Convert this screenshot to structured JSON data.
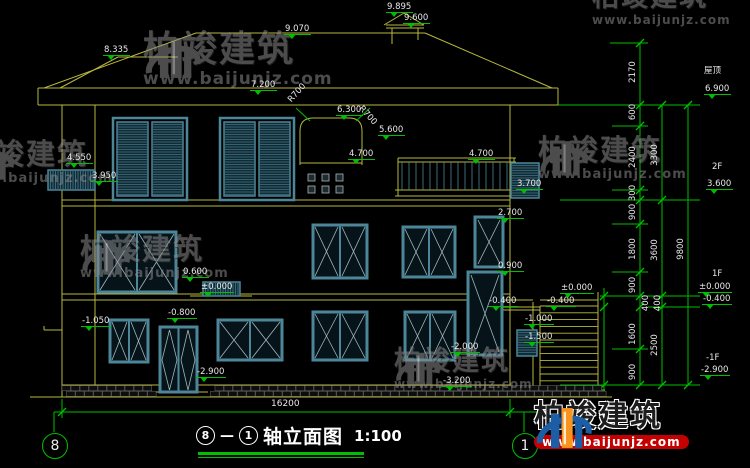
{
  "drawing": {
    "title": {
      "axis_start": "8",
      "axis_end": "1",
      "dash": "—",
      "name": "轴立面图",
      "scale": "1:100"
    },
    "axis_bubbles": {
      "left": "8",
      "right": "1"
    },
    "total_width_dim": "16200",
    "elevation_markers": [
      {
        "t": "9.895",
        "x": 386,
        "y": 2
      },
      {
        "t": "9.600",
        "x": 403,
        "y": 13
      },
      {
        "t": "9.070",
        "x": 284,
        "y": 24
      },
      {
        "t": "8.335",
        "x": 103,
        "y": 45
      },
      {
        "t": "7.200",
        "x": 250,
        "y": 80
      },
      {
        "t": "6.300",
        "x": 336,
        "y": 105
      },
      {
        "t": "5.600",
        "x": 378,
        "y": 125
      },
      {
        "t": "4.700",
        "x": 348,
        "y": 149
      },
      {
        "t": "4.700",
        "x": 468,
        "y": 149
      },
      {
        "t": "3.700",
        "x": 516,
        "y": 179
      },
      {
        "t": "4.550",
        "x": 66,
        "y": 153
      },
      {
        "t": "3.950",
        "x": 91,
        "y": 171
      },
      {
        "t": "2.700",
        "x": 497,
        "y": 208
      },
      {
        "t": "0.900",
        "x": 497,
        "y": 261
      },
      {
        "t": "0.600",
        "x": 182,
        "y": 267
      },
      {
        "t": "±0.000",
        "x": 200,
        "y": 282
      },
      {
        "t": "-0.800",
        "x": 167,
        "y": 308
      },
      {
        "t": "-1.050",
        "x": 81,
        "y": 316
      },
      {
        "t": "-2.900",
        "x": 196,
        "y": 367
      },
      {
        "t": "-0.400",
        "x": 488,
        "y": 296
      },
      {
        "t": "-0.400",
        "x": 546,
        "y": 296
      },
      {
        "t": "-1.000",
        "x": 524,
        "y": 314
      },
      {
        "t": "-1.500",
        "x": 524,
        "y": 332
      },
      {
        "t": "-2.000",
        "x": 450,
        "y": 342
      },
      {
        "t": "±0.000",
        "x": 560,
        "y": 283
      },
      {
        "t": "-3.200",
        "x": 442,
        "y": 376
      },
      {
        "t": "6.900",
        "x": 704,
        "y": 84
      },
      {
        "t": "3.600",
        "x": 706,
        "y": 179
      },
      {
        "t": "±0.000",
        "x": 698,
        "y": 282
      },
      {
        "t": "-0.400",
        "x": 702,
        "y": 294
      },
      {
        "t": "-2.900",
        "x": 700,
        "y": 365
      }
    ],
    "level_names": [
      {
        "t": "屋顶",
        "x": 704,
        "y": 66
      },
      {
        "t": "2F",
        "x": 712,
        "y": 162
      },
      {
        "t": "1F",
        "x": 712,
        "y": 269
      },
      {
        "t": "-1F",
        "x": 706,
        "y": 353
      }
    ],
    "rotated_dims": [
      {
        "t": "2170",
        "x": 633,
        "y": 72
      },
      {
        "t": "600",
        "x": 633,
        "y": 112
      },
      {
        "t": "2400",
        "x": 633,
        "y": 157
      },
      {
        "t": "300",
        "x": 633,
        "y": 193
      },
      {
        "t": "900",
        "x": 633,
        "y": 212
      },
      {
        "t": "1800",
        "x": 633,
        "y": 249
      },
      {
        "t": "900",
        "x": 633,
        "y": 285
      },
      {
        "t": "400",
        "x": 646,
        "y": 303
      },
      {
        "t": "1600",
        "x": 633,
        "y": 334
      },
      {
        "t": "900",
        "x": 633,
        "y": 372
      },
      {
        "t": "3300",
        "x": 655,
        "y": 155
      },
      {
        "t": "3600",
        "x": 655,
        "y": 250
      },
      {
        "t": "400",
        "x": 658,
        "y": 303
      },
      {
        "t": "2500",
        "x": 655,
        "y": 345
      },
      {
        "t": "9800",
        "x": 681,
        "y": 249
      }
    ],
    "radius_labels": [
      {
        "t": "R700",
        "x": 286,
        "y": 98,
        "r": -48
      },
      {
        "t": "R700",
        "x": 364,
        "y": 104,
        "r": 48
      }
    ]
  },
  "watermark": {
    "brand": "柏竣建筑",
    "url": "www.baijunjz.com",
    "gray_instances": [
      {
        "x": 143,
        "y": 32,
        "text": 36,
        "url_size": 17,
        "logo": 58
      },
      {
        "x": 538,
        "y": 136,
        "text": 29,
        "url_size": 13,
        "logo": 50
      },
      {
        "x": 80,
        "y": 235,
        "text": 29,
        "url_size": 13,
        "logo": 50
      },
      {
        "x": 394,
        "y": 348,
        "text": 27,
        "url_size": 12,
        "logo": 46
      },
      {
        "x": 592,
        "y": -16,
        "text": 27,
        "url_size": 12,
        "logo": 0
      },
      {
        "x": -36,
        "y": 140,
        "text": 29,
        "url_size": 13,
        "logo": 50
      }
    ],
    "color_instance": {
      "x": 534,
      "y": 402,
      "text": 30,
      "url_size": 12,
      "logo": 58
    }
  },
  "colors": {
    "line_yellow": "#b9b93c",
    "dim_green": "#00bf00",
    "window_teal": "#4d8699",
    "glass_line": "#9fb6bd",
    "text_white": "#e8e8e8",
    "logo_blue": "#1b5ea6",
    "logo_orange": "#f7941d",
    "logo_red": "#c40000",
    "watermark_gray": "#8a8a8a"
  }
}
